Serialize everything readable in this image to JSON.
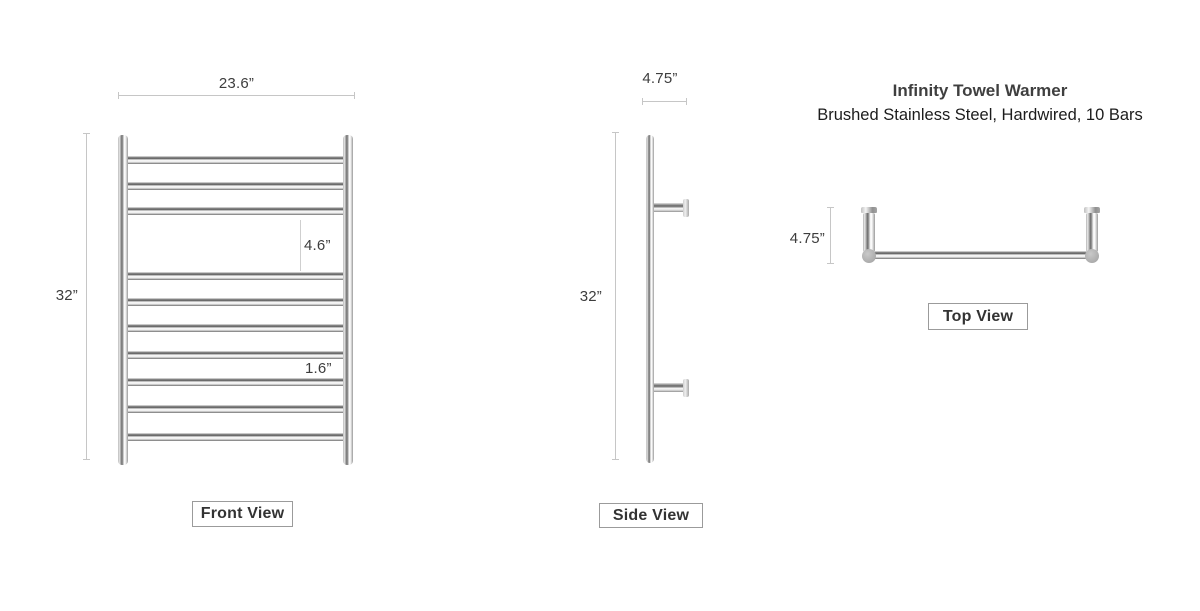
{
  "product": {
    "title": "Infinity Towel Warmer",
    "subtitle": "Brushed Stainless Steel, Hardwired, 10 Bars"
  },
  "front_view": {
    "label": "Front View",
    "width": "23.6”",
    "height": "32”",
    "towel_gap": "4.6”",
    "bar_spacing": "1.6”",
    "bar_count": 10
  },
  "side_view": {
    "label": "Side View",
    "depth": "4.75”",
    "height": "32”"
  },
  "top_view": {
    "label": "Top View",
    "depth": "4.75”"
  },
  "colors": {
    "dim_line": "#c6c6c6",
    "dim_text": "#3d3d3d",
    "label_border": "#9b9b9b",
    "chrome_dark": "#5f5f5f",
    "chrome_light": "#ffffff",
    "joint_gray": "#aeaeae"
  }
}
